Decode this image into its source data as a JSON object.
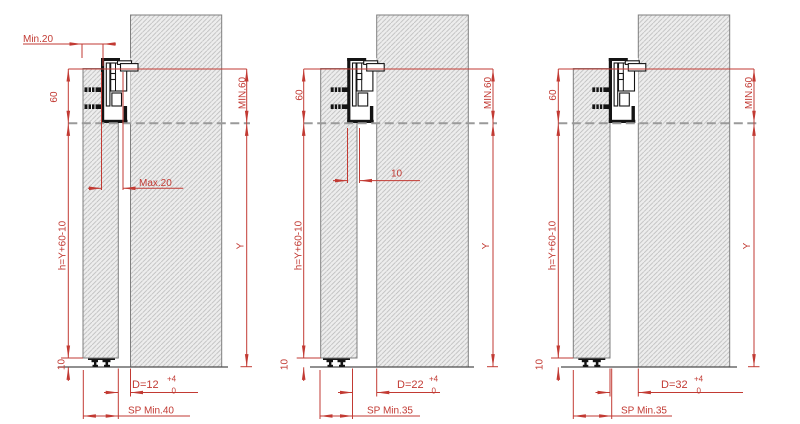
{
  "drawing": {
    "type": "sliding-door-track-installation-sections",
    "colors": {
      "dimension_red": "#c23a33",
      "wall_outline_gray": "#7f7f7f",
      "hatch_gray": "#bcbcbc",
      "wall_fill": "#ededed",
      "dashed_reference_gray": "#9a9a9a",
      "profile_black": "#141414"
    }
  },
  "diagrams": [
    {
      "name": "variant-d12",
      "dims": {
        "front_overlap_min": "Min.20",
        "profile_height": "60",
        "min_top_clearance": "MIN.60",
        "side_adjustment": "Max.20",
        "door_height_formula": "h=Y+60-10",
        "floor_clearance": "10",
        "opening_height": "Y",
        "door_distance": "D=12",
        "tolerance_upper": "+4",
        "tolerance_lower": "0",
        "min_wall_thickness": "SP Min.40"
      }
    },
    {
      "name": "variant-d22",
      "dims": {
        "profile_height": "60",
        "min_top_clearance": "MIN.60",
        "side_adjustment": "10",
        "door_height_formula": "h=Y+60-10",
        "floor_clearance": "10",
        "opening_height": "Y",
        "door_distance": "D=22",
        "tolerance_upper": "+4",
        "tolerance_lower": "0",
        "min_wall_thickness": "SP Min.35"
      }
    },
    {
      "name": "variant-d32",
      "dims": {
        "profile_height": "60",
        "min_top_clearance": "MIN.60",
        "door_height_formula": "h=Y+60-10",
        "floor_clearance": "10",
        "opening_height": "Y",
        "door_distance": "D=32",
        "tolerance_upper": "+4",
        "tolerance_lower": "0",
        "min_wall_thickness": "SP Min.35"
      }
    }
  ]
}
